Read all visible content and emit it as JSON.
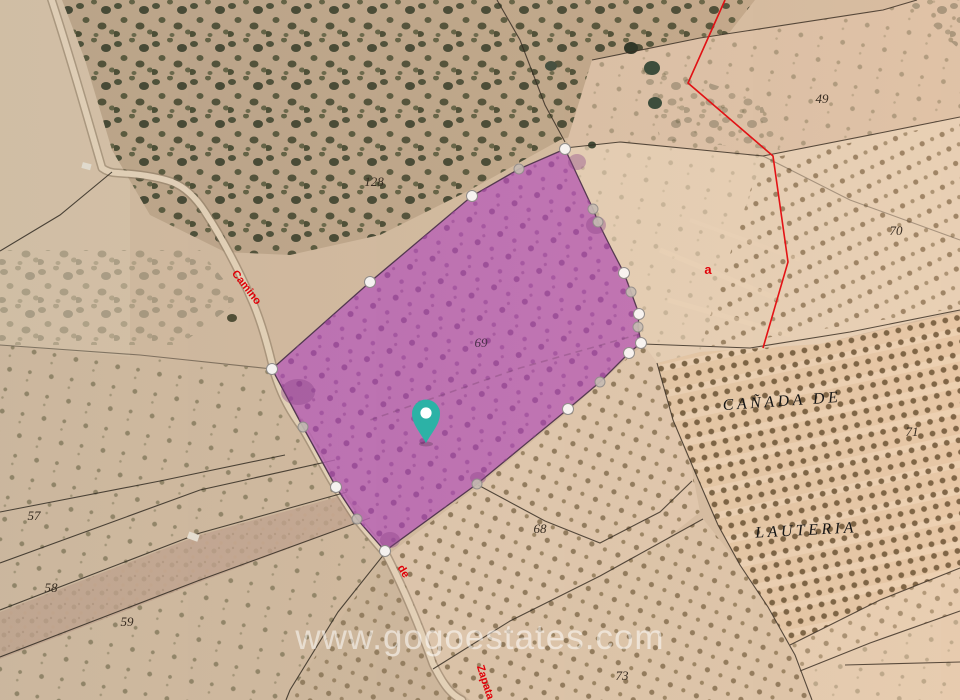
{
  "map": {
    "watermark": "www.gogoestates.com",
    "place_names": {
      "line1": "CAÑADA DE",
      "line2": "LAUTERIA"
    },
    "road_labels": {
      "camino": "Camino",
      "de": "de",
      "zapata": "Zapata"
    },
    "subparcel_letter": "a",
    "parcel_numbers": {
      "n49": "49",
      "n57": "57",
      "n58": "58",
      "n59": "59",
      "n68": "68",
      "n69": "69",
      "n70": "70",
      "n71": "71",
      "n73": "73",
      "n128": "128"
    },
    "colors": {
      "highlight_parcel_fill": "#bc5fbe",
      "highlight_parcel_dots": "#8f3b94",
      "pin_teal": "#2cb2a6",
      "cadastral_red": "#e60008",
      "boundary_black": "#241f17",
      "watermark_white": "#ffffff",
      "terrain_sand": "#d7c0a5"
    }
  }
}
